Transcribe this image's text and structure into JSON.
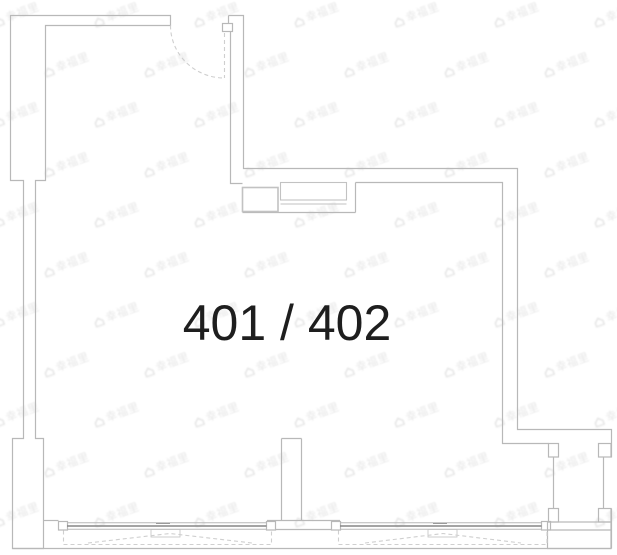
{
  "room_label": "401 / 402",
  "watermark": {
    "text": "幸福里",
    "icon": "house-icon"
  },
  "colors": {
    "background": "#ffffff",
    "wall_line": "#b8b8b8",
    "fixture_line": "#c2c2c2",
    "window_line": "#868686",
    "dashed_line": "#cfcfcf",
    "label_text": "#1e1e1e",
    "watermark": "#e7e7e7"
  }
}
